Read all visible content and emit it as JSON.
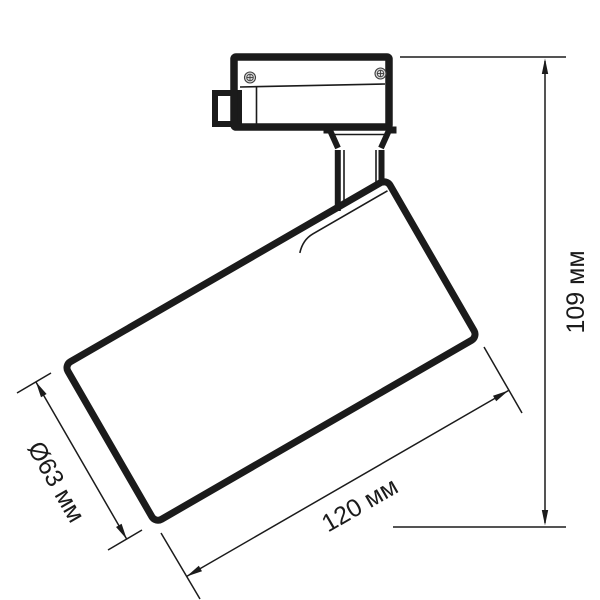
{
  "drawing": {
    "kind": "technical-dimension-drawing",
    "subject": "track-mounted spotlight luminaire",
    "line_color": "#1b1b1b",
    "background_color": "#ffffff",
    "screw_fill_color": "#d9d9d9",
    "labels": {
      "height": "109 мм",
      "length": "120 мм",
      "diameter": "Ø63 мм"
    }
  }
}
